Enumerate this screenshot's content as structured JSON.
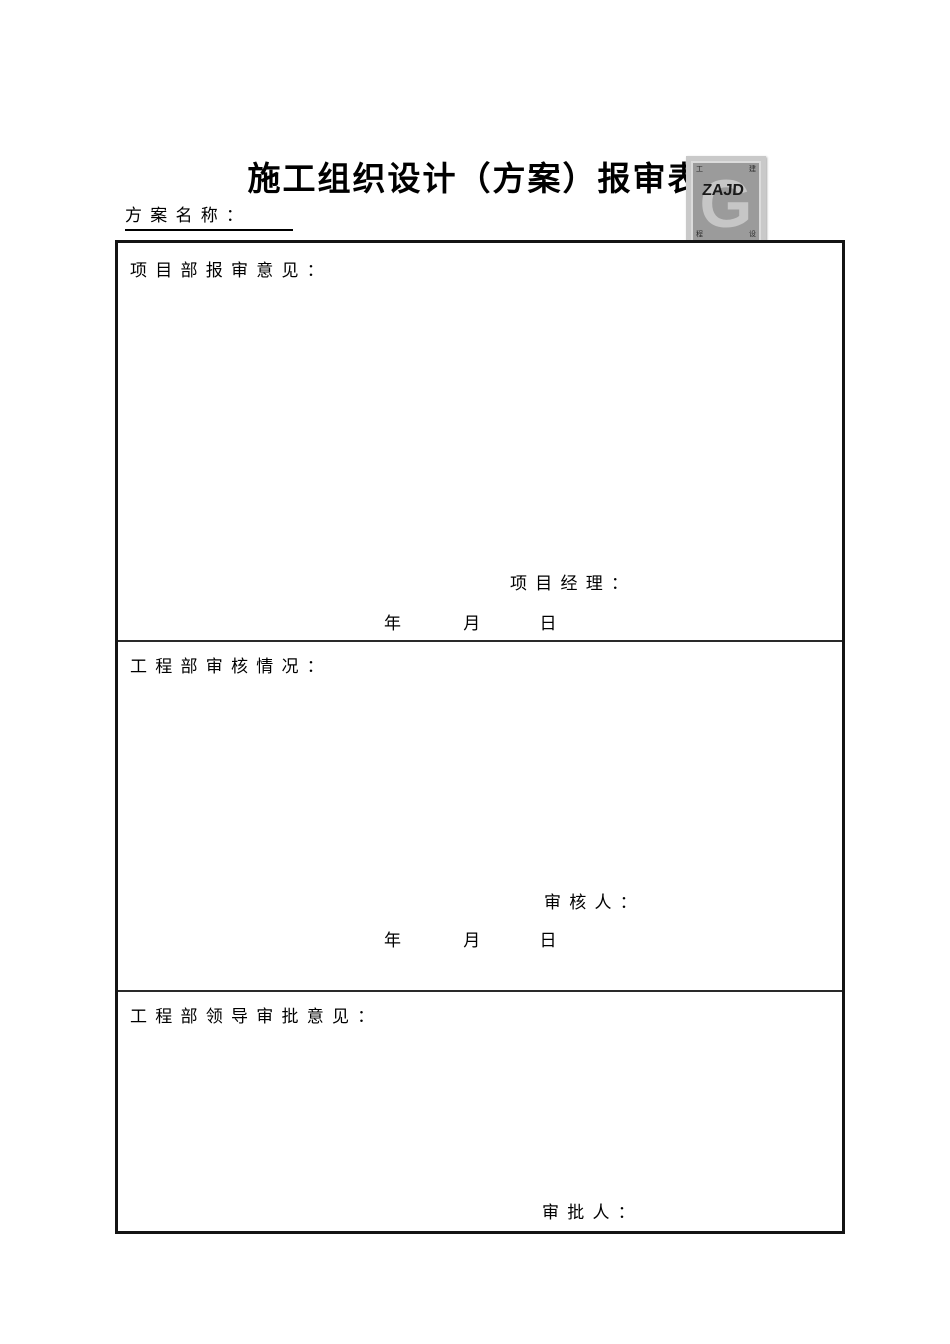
{
  "doc": {
    "title": "施工组织设计（方案）报审表",
    "plan_name_label": "方 案 名 称 ：",
    "stamp": {
      "letter": "G",
      "text": "ZAJD",
      "corner_tl": "工",
      "corner_tr": "建",
      "corner_bl": "程",
      "corner_br": "设"
    },
    "sections": [
      {
        "header": "项 目 部 报 审 意 见 ：",
        "signature_label": "项 目 经 理 ：",
        "date": {
          "year": "年",
          "month": "月",
          "day": "日"
        }
      },
      {
        "header": "工 程 部 审 核 情 况 ：",
        "signature_label": "审 核 人 ：",
        "date": {
          "year": "年",
          "month": "月",
          "day": "日"
        }
      },
      {
        "header": "工 程 部 领 导 审 批 意 见 ：",
        "signature_label": "审 批 人 ："
      }
    ],
    "colors": {
      "table_border": "#141414",
      "row_divider": "#2a2a2a",
      "stamp_frame": "#c9c9c9",
      "stamp_background": "#9b9b9b",
      "stamp_letter": "#c6c6c6",
      "stamp_text": "#1a1a1a"
    }
  }
}
